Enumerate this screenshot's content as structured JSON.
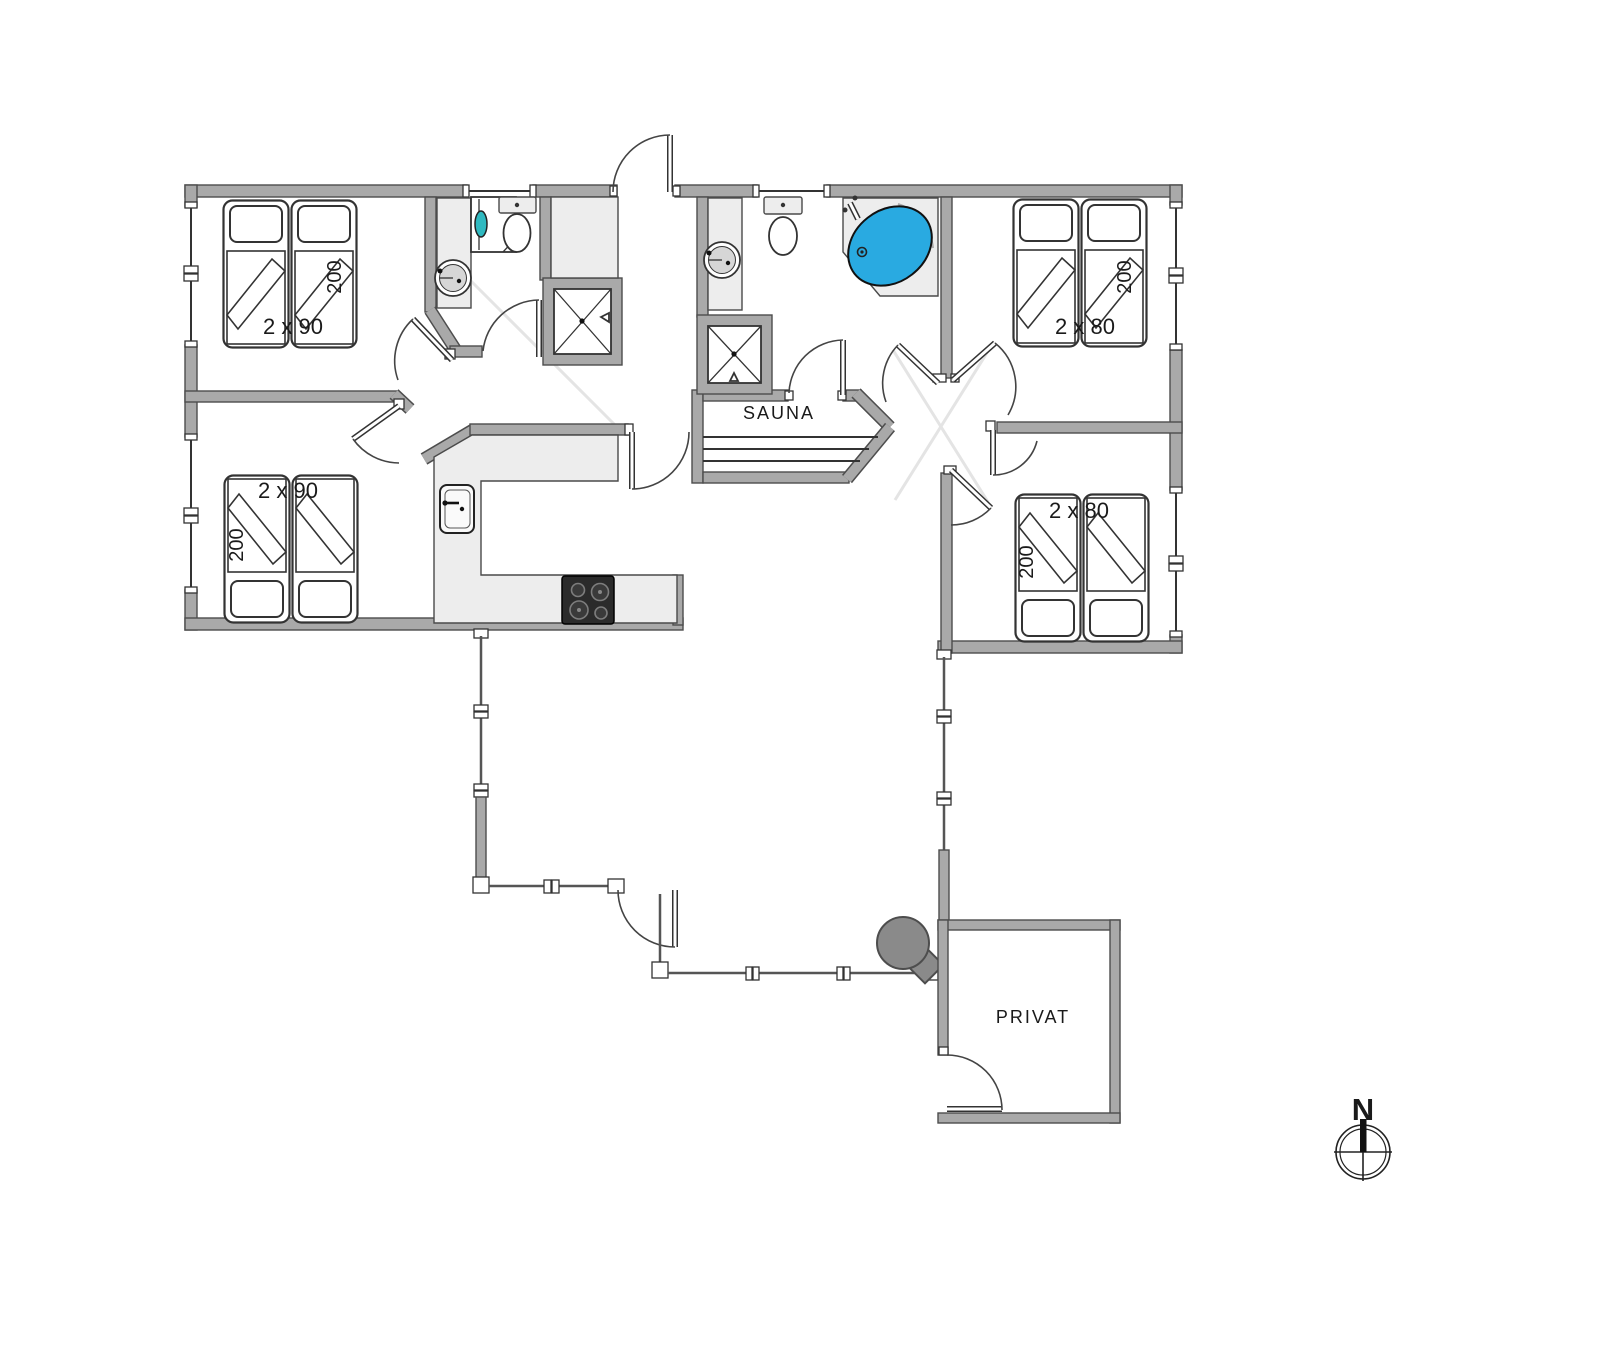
{
  "floorplan": {
    "rooms": {
      "bedroom_top_left": {
        "bed_size": "2 x 90",
        "bed_length": "200"
      },
      "bedroom_bottom_left": {
        "bed_size": "2 x 90",
        "bed_length": "200"
      },
      "bedroom_top_right": {
        "bed_size": "2 x 80",
        "bed_length": "200"
      },
      "bedroom_bottom_right": {
        "bed_size": "2 x 80",
        "bed_length": "200"
      },
      "sauna": {
        "label": "SAUNA"
      },
      "privat": {
        "label": "PRIVAT"
      }
    },
    "compass": {
      "north_label": "N"
    },
    "colors": {
      "wall": "#a9a9a9",
      "wall_outline": "#4d4d4d",
      "fixture_light": "#ededed",
      "spa_water": "#29aae1",
      "washer_door": "#2fb9c0",
      "grill": "#8a8a8a",
      "stove": "#2b2b2b"
    }
  }
}
